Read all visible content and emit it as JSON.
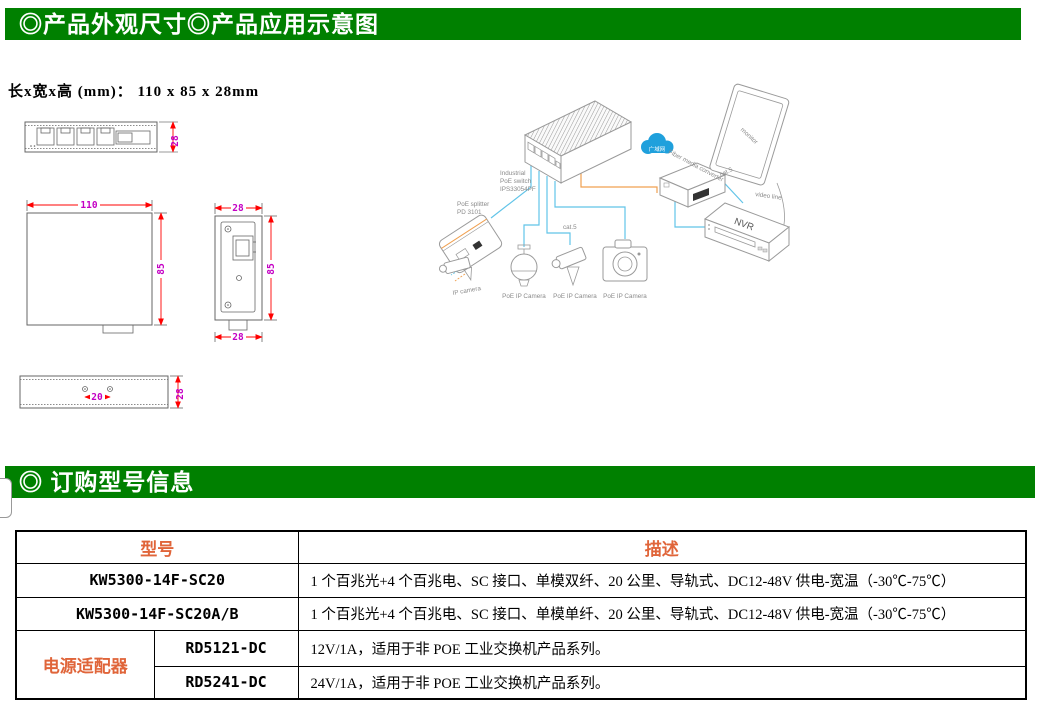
{
  "colors": {
    "header_green": "#008000",
    "header_text": "#ffffff",
    "accent_orange": "#E0653A",
    "dim_line_red": "#FF0000",
    "dim_text_magenta": "#C400C4",
    "diagram_cable_blue": "#62C4E8",
    "diagram_cable_orange": "#F0A050",
    "cloud_blue": "#1FA0DC"
  },
  "section1": {
    "title": "◎产品外观尺寸◎产品应用示意图",
    "size_label": "长x宽x高 (mm)：  110 x 85 x 28mm"
  },
  "drawings": {
    "front_height": "28",
    "top_width": "110",
    "top_height": "85",
    "side_width_top": "28",
    "side_height": "85",
    "side_width_bottom": "28",
    "bottom_hole_span": "20",
    "bottom_height": "28"
  },
  "diagram": {
    "switch_label_lines": [
      "Industrial",
      "PoE switch",
      "IPS33054PF"
    ],
    "wan_label": "广域网",
    "fiber_converter_label": "Fiber media converter",
    "monitor_label": "monitor",
    "cat5_label_1": "cat.5",
    "cat5_label_2": "cat.5",
    "video_line_label": "video line",
    "nvr_label": "NVR",
    "splitter_label_lines": [
      "PoE splitter",
      "PD 3101"
    ],
    "ip_camera_label": "IP camera",
    "poe_camera_labels": [
      "PoE IP Camera",
      "PoE IP Camera",
      "PoE IP Camera"
    ]
  },
  "section2": {
    "title": "◎ 订购型号信息"
  },
  "order_table": {
    "headers": {
      "model": "型号",
      "description": "描述"
    },
    "rows": [
      {
        "model": "KW5300-14F-SC20",
        "description": "1 个百兆光+4 个百兆电、SC 接口、单模双纤、20 公里、导轨式、DC12-48V 供电-宽温（-30℃-75℃）"
      },
      {
        "model": "KW5300-14F-SC20A/B",
        "description": "1 个百兆光+4 个百兆电、SC 接口、单模单纤、20 公里、导轨式、DC12-48V 供电-宽温（-30℃-75℃）"
      }
    ],
    "adapter_group": {
      "label": "电源适配器",
      "rows": [
        {
          "model": "RD5121-DC",
          "description": "12V/1A，适用于非 POE 工业交换机产品系列。"
        },
        {
          "model": "RD5241-DC",
          "description": "24V/1A，适用于非 POE 工业交换机产品系列。"
        }
      ]
    }
  }
}
